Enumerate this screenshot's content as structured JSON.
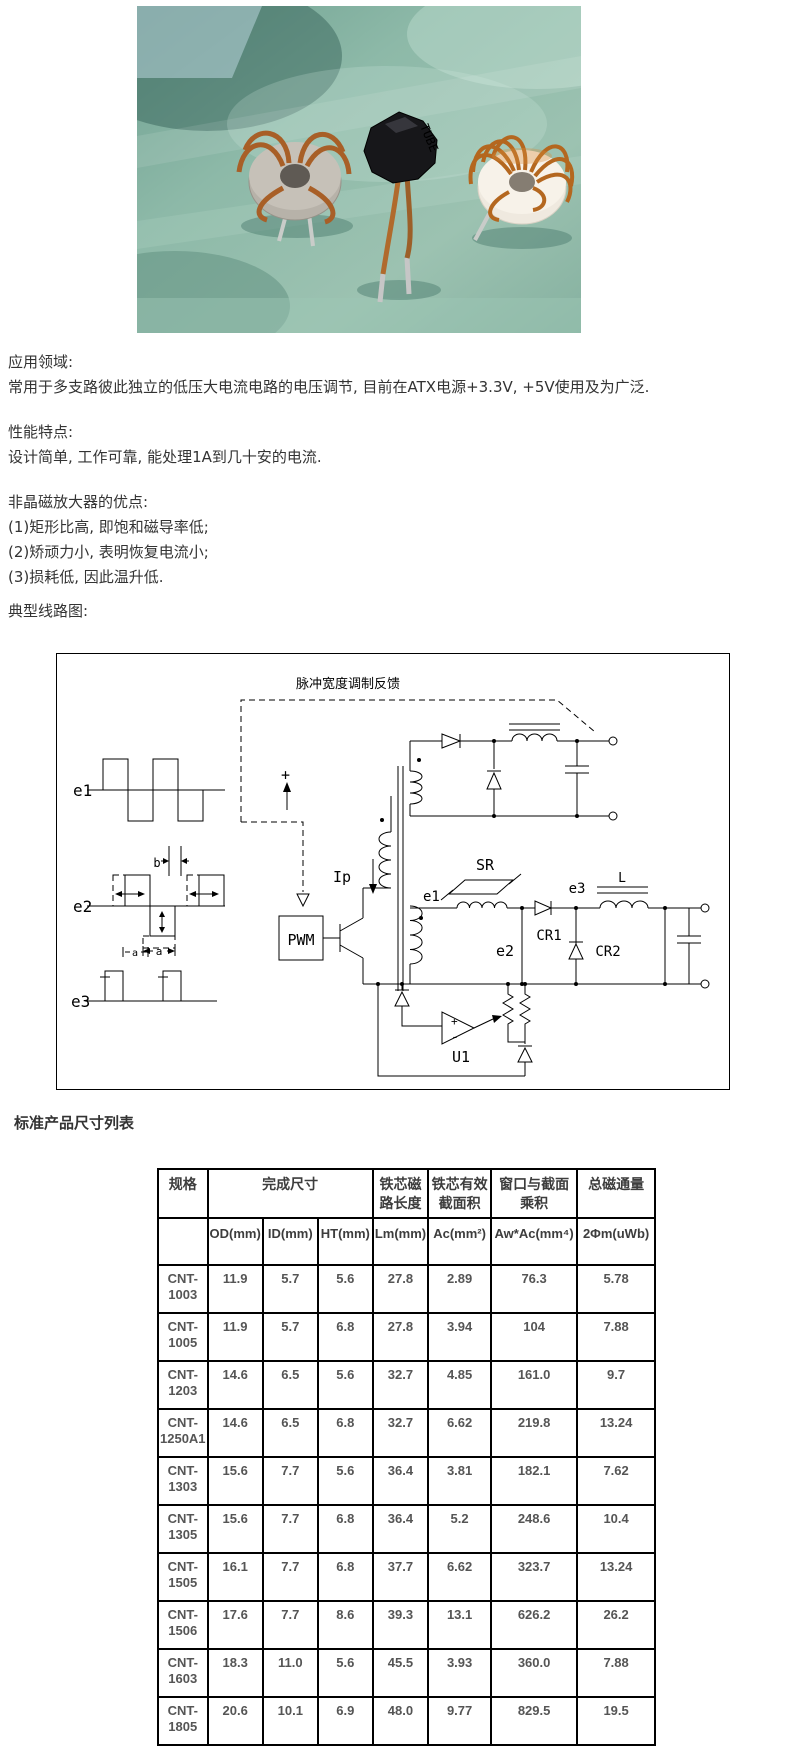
{
  "photo": {
    "tube_label": "TUBE"
  },
  "sections": [
    {
      "heading": "应用领域:",
      "lines": [
        "常用于多支路彼此独立的低压大电流电路的电压调节, 目前在ATX电源+3.3V, +5V使用及为广泛."
      ]
    },
    {
      "heading": "性能特点:",
      "lines": [
        "设计简单, 工作可靠, 能处理1A到几十安的电流."
      ]
    },
    {
      "heading": "非晶磁放大器的优点:",
      "lines": [
        "(1)矩形比高, 即饱和磁导率低;",
        "(2)矫顽力小, 表明恢复电流小;",
        "(3)损耗低, 因此温升低."
      ]
    },
    {
      "heading": "典型线路图:",
      "lines": []
    }
  ],
  "diagram": {
    "feedback_label": "脉冲宽度调制反馈",
    "pwm": "PWM",
    "ip": "Ip",
    "plus": "+",
    "wave_e1": "e1",
    "wave_e2": "e2",
    "wave_e3": "e3",
    "dim_a": "a",
    "dim_a2": "a",
    "dim_b": "b",
    "coil_e1": "e1",
    "coil_e2": "e2",
    "coil_e3": "e3",
    "sr": "SR",
    "cr1": "CR1",
    "cr2": "CR2",
    "l": "L",
    "u1": "U1",
    "u1_plus": "+",
    "u1_minus": "-"
  },
  "table_title": "标准产品尺寸列表",
  "table": {
    "header1": [
      "规格",
      "完成尺寸",
      "铁芯磁路长度",
      "铁芯有效截面积",
      "窗口与截面乘积",
      "总磁通量"
    ],
    "header2": [
      "",
      "OD(mm)",
      "ID(mm)",
      "HT(mm)",
      "Lm(mm)",
      "Ac(mm²)",
      "Aw*Ac(mm⁴)",
      "2Φm(uWb)"
    ],
    "col_keys": [
      "spec",
      "od",
      "id",
      "ht",
      "lm",
      "ac",
      "awac",
      "flux"
    ],
    "rows": [
      {
        "spec": "CNT-1003",
        "od": "11.9",
        "id": "5.7",
        "ht": "5.6",
        "lm": "27.8",
        "ac": "2.89",
        "awac": "76.3",
        "flux": "5.78"
      },
      {
        "spec": "CNT-1005",
        "od": "11.9",
        "id": "5.7",
        "ht": "6.8",
        "lm": "27.8",
        "ac": "3.94",
        "awac": "104",
        "flux": "7.88"
      },
      {
        "spec": "CNT-1203",
        "od": "14.6",
        "id": "6.5",
        "ht": "5.6",
        "lm": "32.7",
        "ac": "4.85",
        "awac": "161.0",
        "flux": "9.7"
      },
      {
        "spec": "CNT-1250A1",
        "od": "14.6",
        "id": "6.5",
        "ht": "6.8",
        "lm": "32.7",
        "ac": "6.62",
        "awac": "219.8",
        "flux": "13.24"
      },
      {
        "spec": "CNT-1303",
        "od": "15.6",
        "id": "7.7",
        "ht": "5.6",
        "lm": "36.4",
        "ac": "3.81",
        "awac": "182.1",
        "flux": "7.62"
      },
      {
        "spec": "CNT-1305",
        "od": "15.6",
        "id": "7.7",
        "ht": "6.8",
        "lm": "36.4",
        "ac": "5.2",
        "awac": "248.6",
        "flux": "10.4"
      },
      {
        "spec": "CNT-1505",
        "od": "16.1",
        "id": "7.7",
        "ht": "6.8",
        "lm": "37.7",
        "ac": "6.62",
        "awac": "323.7",
        "flux": "13.24"
      },
      {
        "spec": "CNT-1506",
        "od": "17.6",
        "id": "7.7",
        "ht": "8.6",
        "lm": "39.3",
        "ac": "13.1",
        "awac": "626.2",
        "flux": "26.2"
      },
      {
        "spec": "CNT-1603",
        "od": "18.3",
        "id": "11.0",
        "ht": "5.6",
        "lm": "45.5",
        "ac": "3.93",
        "awac": "360.0",
        "flux": "7.88"
      },
      {
        "spec": "CNT-1805",
        "od": "20.6",
        "id": "10.1",
        "ht": "6.9",
        "lm": "48.0",
        "ac": "9.77",
        "awac": "829.5",
        "flux": "19.5"
      }
    ]
  }
}
